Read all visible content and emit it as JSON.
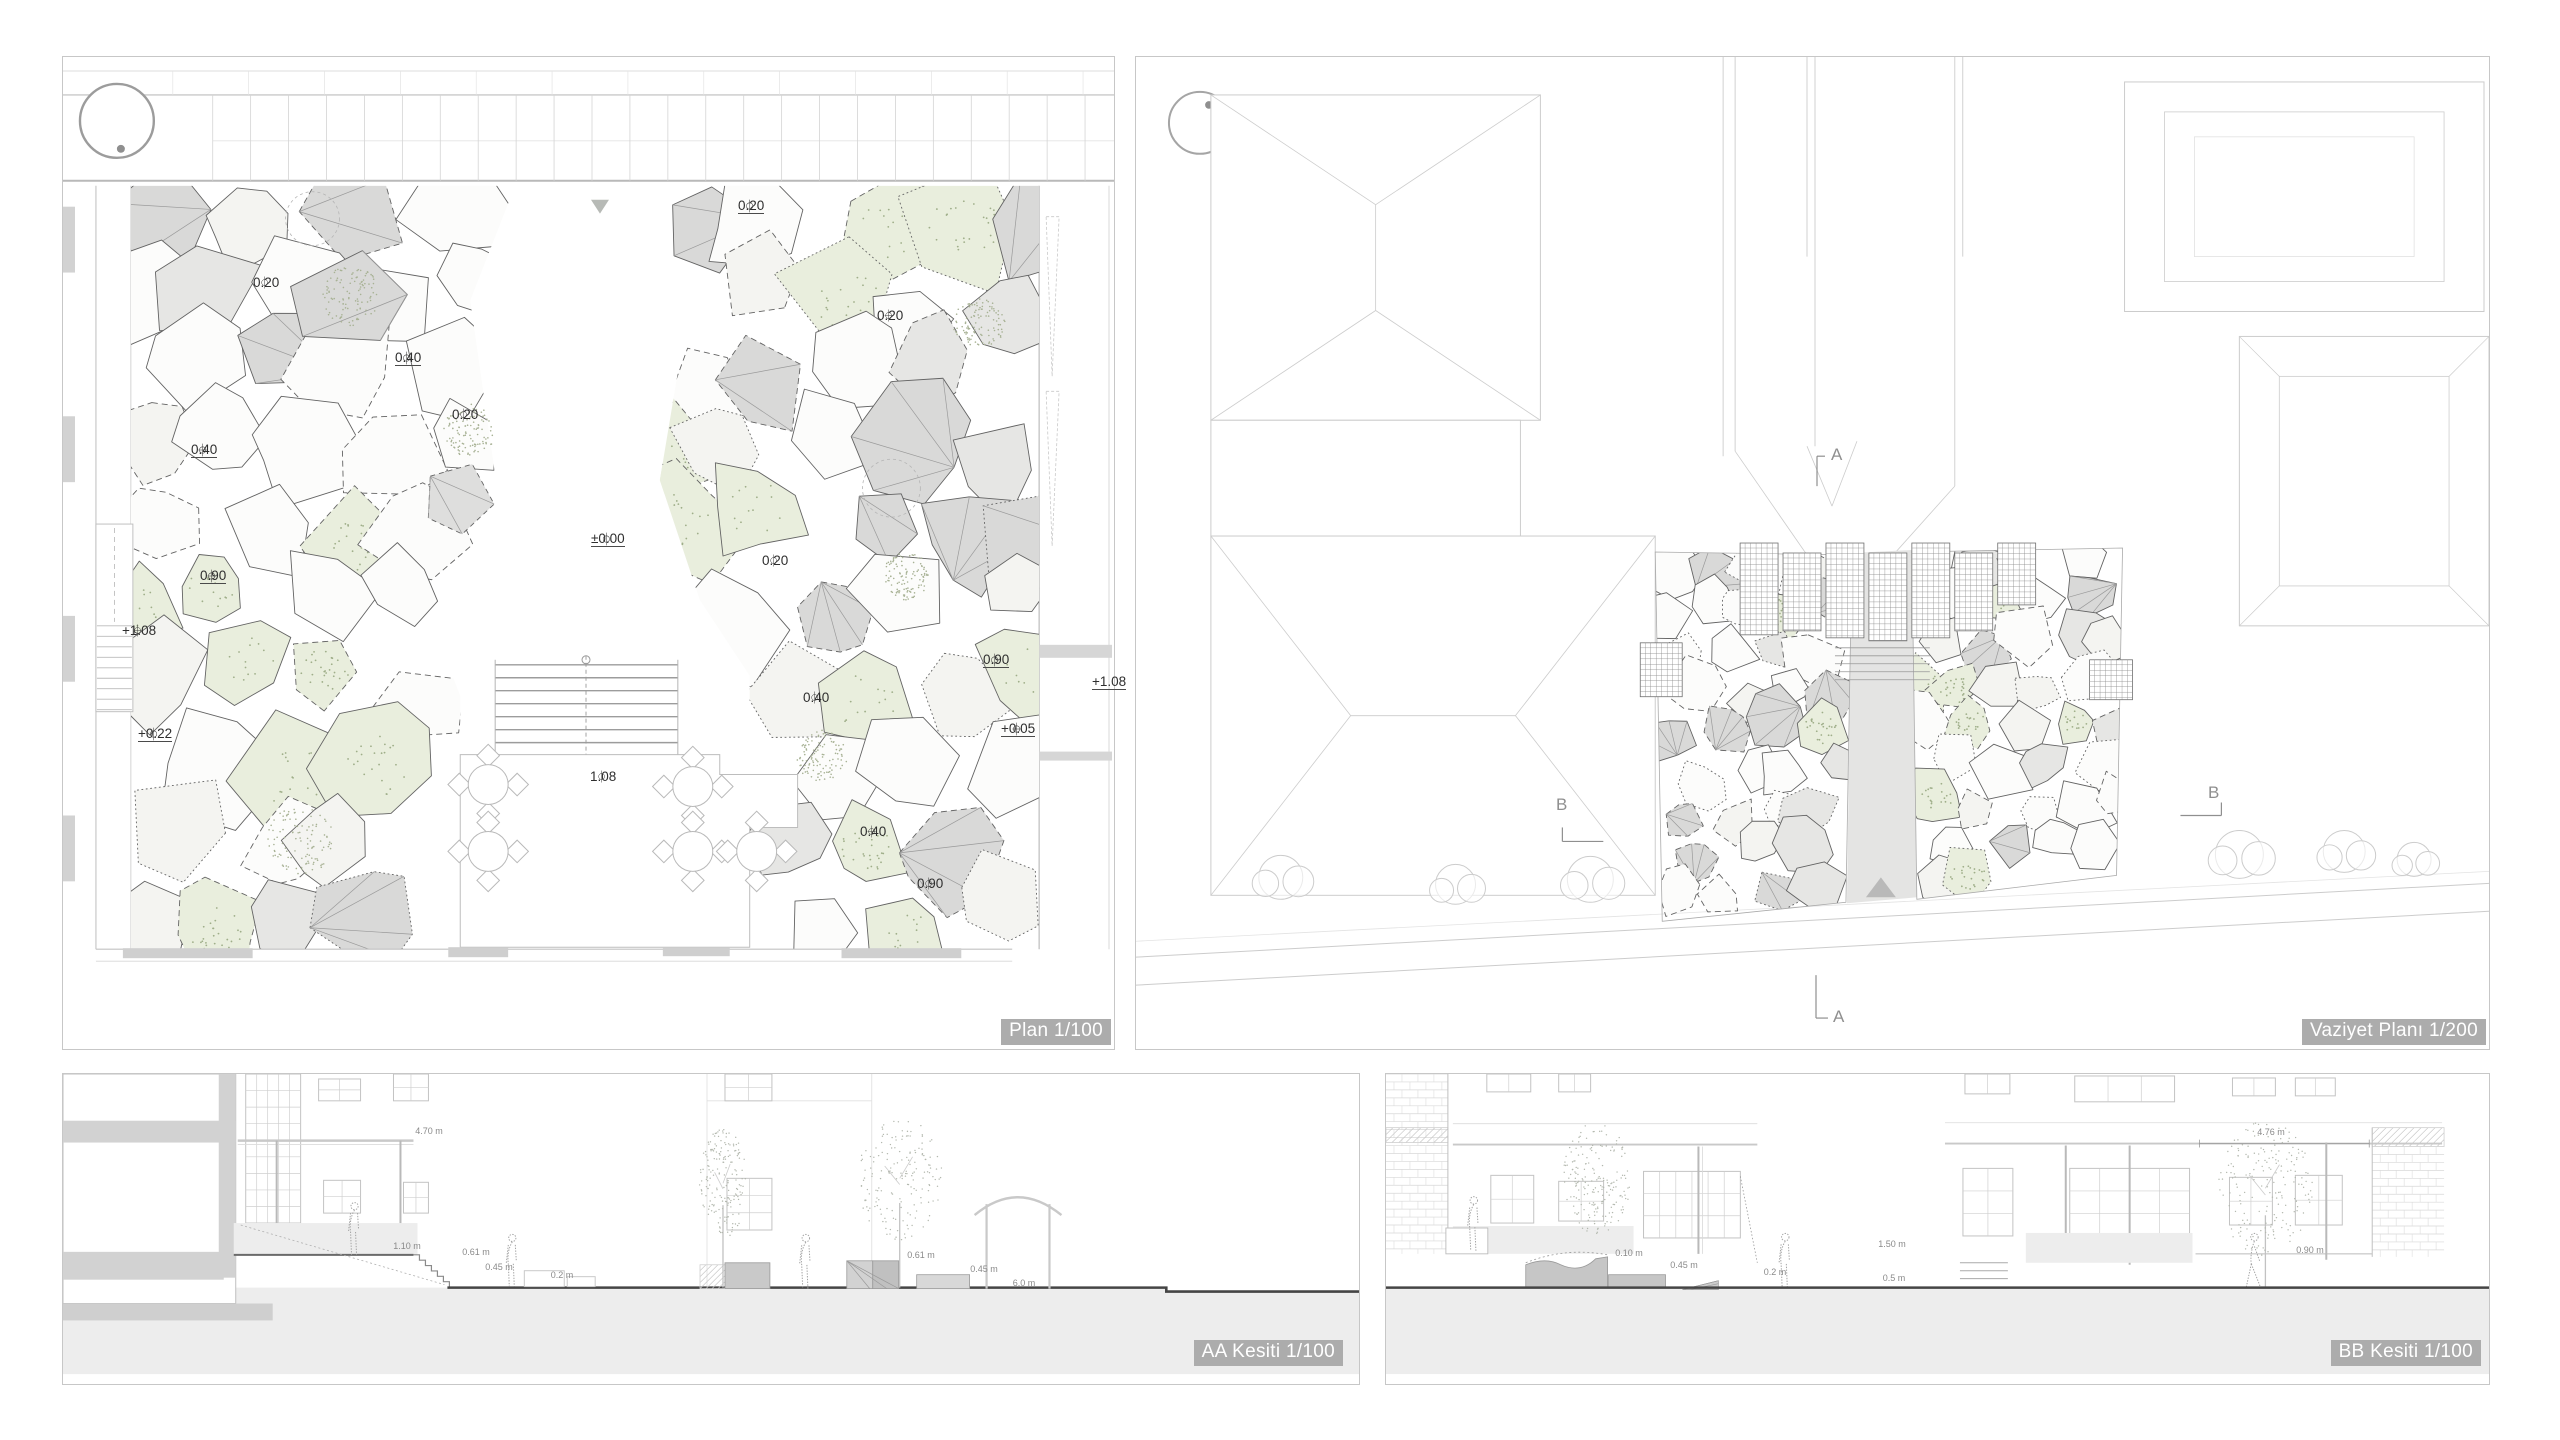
{
  "sheet": {
    "background": "#ffffff"
  },
  "colors": {
    "panel_border": "#c7c7c7",
    "cell_stroke": "#636363",
    "white_fill": "#fcfcfb",
    "offwhite_fill": "#f4f4f1",
    "green_fill": "#e9eedd",
    "green_dot": "#9fae89",
    "lightgray_fill": "#e6e6e4",
    "gray_fill": "#d9d9d8",
    "building_line": "#cccccc",
    "poche": "#d2d2d2",
    "path_gray": "#e4e4e3",
    "triangle_gray": "#b7bab6",
    "ground_dark": "#454545",
    "underground": "#ededed",
    "chip_bg": "#acacac",
    "chip_text": "#ffffff"
  },
  "panels": {
    "plan": {
      "title": "Plan 1/100",
      "spot_elevations": [
        {
          "x": 196,
          "y": 233,
          "label": "0.20",
          "icon": "circle",
          "underline": false
        },
        {
          "x": 338,
          "y": 308,
          "label": "0.40",
          "icon": "circle",
          "underline": true
        },
        {
          "x": 395,
          "y": 365,
          "label": "0.20",
          "icon": "circle",
          "underline": false
        },
        {
          "x": 681,
          "y": 156,
          "label": "0.20",
          "icon": "circle",
          "underline": true
        },
        {
          "x": 820,
          "y": 266,
          "label": "0.20",
          "icon": "cross",
          "underline": false
        },
        {
          "x": 134,
          "y": 400,
          "label": "0.40",
          "icon": "cross",
          "underline": true
        },
        {
          "x": 534,
          "y": 489,
          "label": "±0.00",
          "icon": "circle",
          "underline": true
        },
        {
          "x": 705,
          "y": 511,
          "label": "0.20",
          "icon": "circle",
          "underline": false
        },
        {
          "x": 143,
          "y": 526,
          "label": "0.90",
          "icon": "cross",
          "underline": true
        },
        {
          "x": 65,
          "y": 581,
          "label": "+1.08",
          "icon": "cross",
          "underline": false
        },
        {
          "x": 926,
          "y": 610,
          "label": "0.90",
          "icon": "circle",
          "underline": true
        },
        {
          "x": 1038,
          "y": 632,
          "label": "+1.08",
          "icon": "none",
          "underline": true
        },
        {
          "x": 746,
          "y": 648,
          "label": "0.40",
          "icon": "circle",
          "underline": false
        },
        {
          "x": 944,
          "y": 679,
          "label": "+0.05",
          "icon": "cross",
          "underline": true
        },
        {
          "x": 81,
          "y": 684,
          "label": "+0.22",
          "icon": "circle",
          "underline": true
        },
        {
          "x": 533,
          "y": 727,
          "label": "1.08",
          "icon": "circle",
          "underline": false
        },
        {
          "x": 803,
          "y": 782,
          "label": "0.40",
          "icon": "cross",
          "underline": false
        },
        {
          "x": 860,
          "y": 834,
          "label": "0.90",
          "icon": "circle",
          "underline": false
        }
      ]
    },
    "site": {
      "title": "Vaziyet Planı 1/200",
      "section_markers": [
        {
          "x": 695,
          "y": 388,
          "label": "A"
        },
        {
          "x": 697,
          "y": 950,
          "label": "A"
        },
        {
          "x": 420,
          "y": 738,
          "label": "B"
        },
        {
          "x": 1072,
          "y": 726,
          "label": "B"
        }
      ]
    },
    "section_aa": {
      "title": "AA Kesiti 1/100",
      "dimensions": [
        {
          "x": 366,
          "y": 57,
          "label": "4.70 m"
        },
        {
          "x": 344,
          "y": 172,
          "label": "1.10 m"
        },
        {
          "x": 413,
          "y": 178,
          "label": "0.61 m"
        },
        {
          "x": 436,
          "y": 193,
          "label": "0.45 m"
        },
        {
          "x": 499,
          "y": 201,
          "label": "0.2 m"
        },
        {
          "x": 858,
          "y": 181,
          "label": "0.61 m"
        },
        {
          "x": 921,
          "y": 195,
          "label": "0.45 m"
        },
        {
          "x": 961,
          "y": 209,
          "label": "6.0 m"
        }
      ]
    },
    "section_bb": {
      "title": "BB Kesiti 1/100",
      "dimensions": [
        {
          "x": 885,
          "y": 58,
          "label": "4.76 m"
        },
        {
          "x": 243,
          "y": 179,
          "label": "0.10 m"
        },
        {
          "x": 298,
          "y": 191,
          "label": "0.45 m"
        },
        {
          "x": 389,
          "y": 198,
          "label": "0.2 m"
        },
        {
          "x": 506,
          "y": 170,
          "label": "1.50 m"
        },
        {
          "x": 508,
          "y": 204,
          "label": "0.5 m"
        },
        {
          "x": 924,
          "y": 176,
          "label": "0.90 m"
        }
      ]
    }
  }
}
